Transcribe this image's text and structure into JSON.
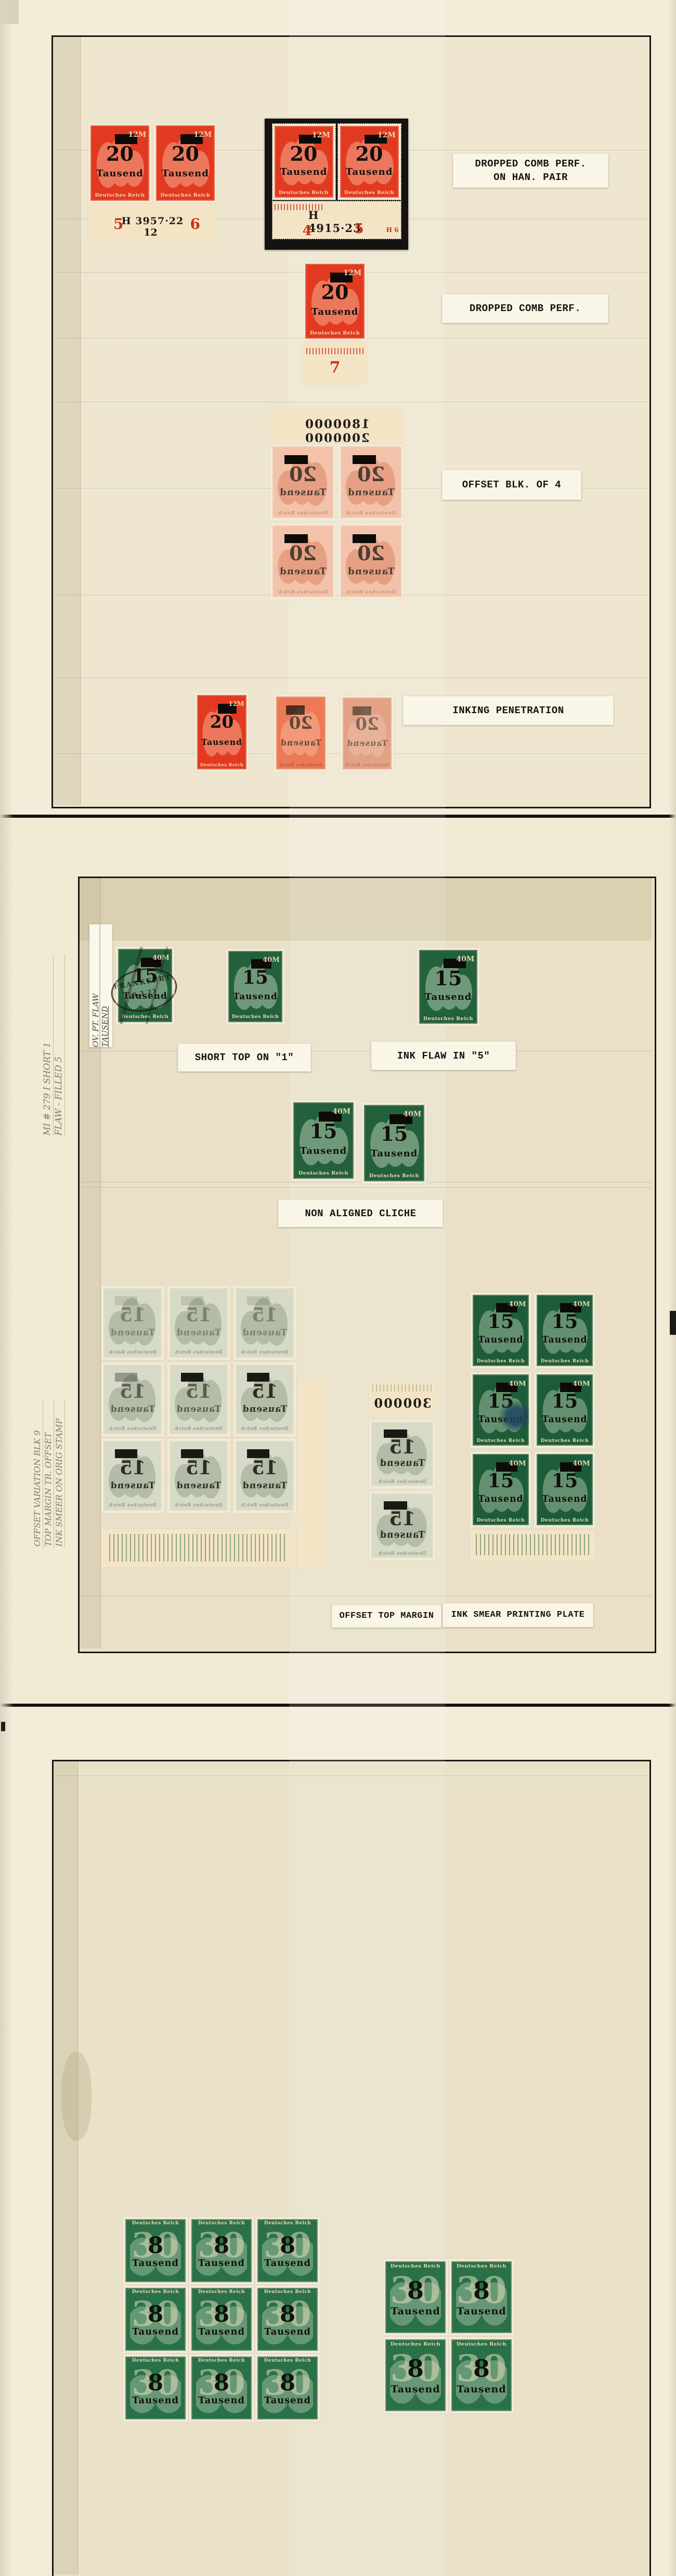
{
  "colors": {
    "album_background": "#f2ecd9",
    "inner_mount_area": "#e9e0c7",
    "box_border": "#1a1712",
    "stamp_red": "#e23a20",
    "stamp_red_offset_pale": "#f2c2aa",
    "stamp_green": "#23603c",
    "stamp_green_dark": "#1d5c39",
    "stamp_green_offset_pale": "#d7dac7",
    "stamp_green_page3": "#2a7048",
    "sheet_selvage": "#f4e4c6",
    "label_paper": "#faf6e7",
    "overprint_ink": "#12100c",
    "red_plate_number": "#c63418",
    "pencil_note": "#837b68",
    "black_mount": "#141310"
  },
  "overprints": {
    "t20": {
      "value": "20",
      "unit": "Tausend",
      "country": "Deutsches Reich",
      "base": "12M"
    },
    "t15": {
      "value": "15",
      "unit": "Tausend",
      "country": "Deutsches Reich",
      "base": "40M"
    },
    "t8": {
      "value": "8",
      "unit": "Tausend",
      "country": "Deutsches Reich",
      "base": "30"
    }
  },
  "page1": {
    "labels": {
      "row1_line1": "DROPPED COMB PERF.",
      "row1_line2": "ON HAN. PAIR",
      "row2": "DROPPED COMB PERF.",
      "row3": "OFFSET BLK. OF 4",
      "row4": "INKING PENETRATION"
    },
    "han_pair_margin": {
      "pos_left": "5",
      "han_number": "H 3957·22",
      "pos_right": "6",
      "control_number": "12"
    },
    "mounted_pair_margin": {
      "han_number": "H 4915·23",
      "pos_left": "4",
      "pos_right": "5",
      "corner_code": "H 6"
    },
    "single_margin": {
      "pos": "7"
    },
    "offset_block_margin": "1800000  2000000"
  },
  "page2": {
    "labels": {
      "short_top": "SHORT TOP ON \"1\"",
      "ink_flaw": "INK FLAW IN \"5\"",
      "non_aligned": "NON ALIGNED CLICHE",
      "offset_top": "OFFSET TOP MARGIN",
      "ink_smear": "INK SMEAR PRINTING PLATE"
    },
    "handwritten": {
      "strip_line1": "OV. PT. FLAW",
      "strip_line2": "TAUSEND",
      "pencil1_line1": "MI # 279 I SHORT 1",
      "pencil1_line2": "FLAW - FILLED 5",
      "pencil2_line1": "OFFSET VARIATION BLK 9",
      "pencil2_line2": "TOP MARGIN TR. OFFSET",
      "pencil2_line3": "INK SMEER ON ORIG STAMP"
    },
    "postmark": {
      "town": "FRANKFURT",
      "date": "9.3.23"
    },
    "offset_strip_margin": "300000"
  }
}
